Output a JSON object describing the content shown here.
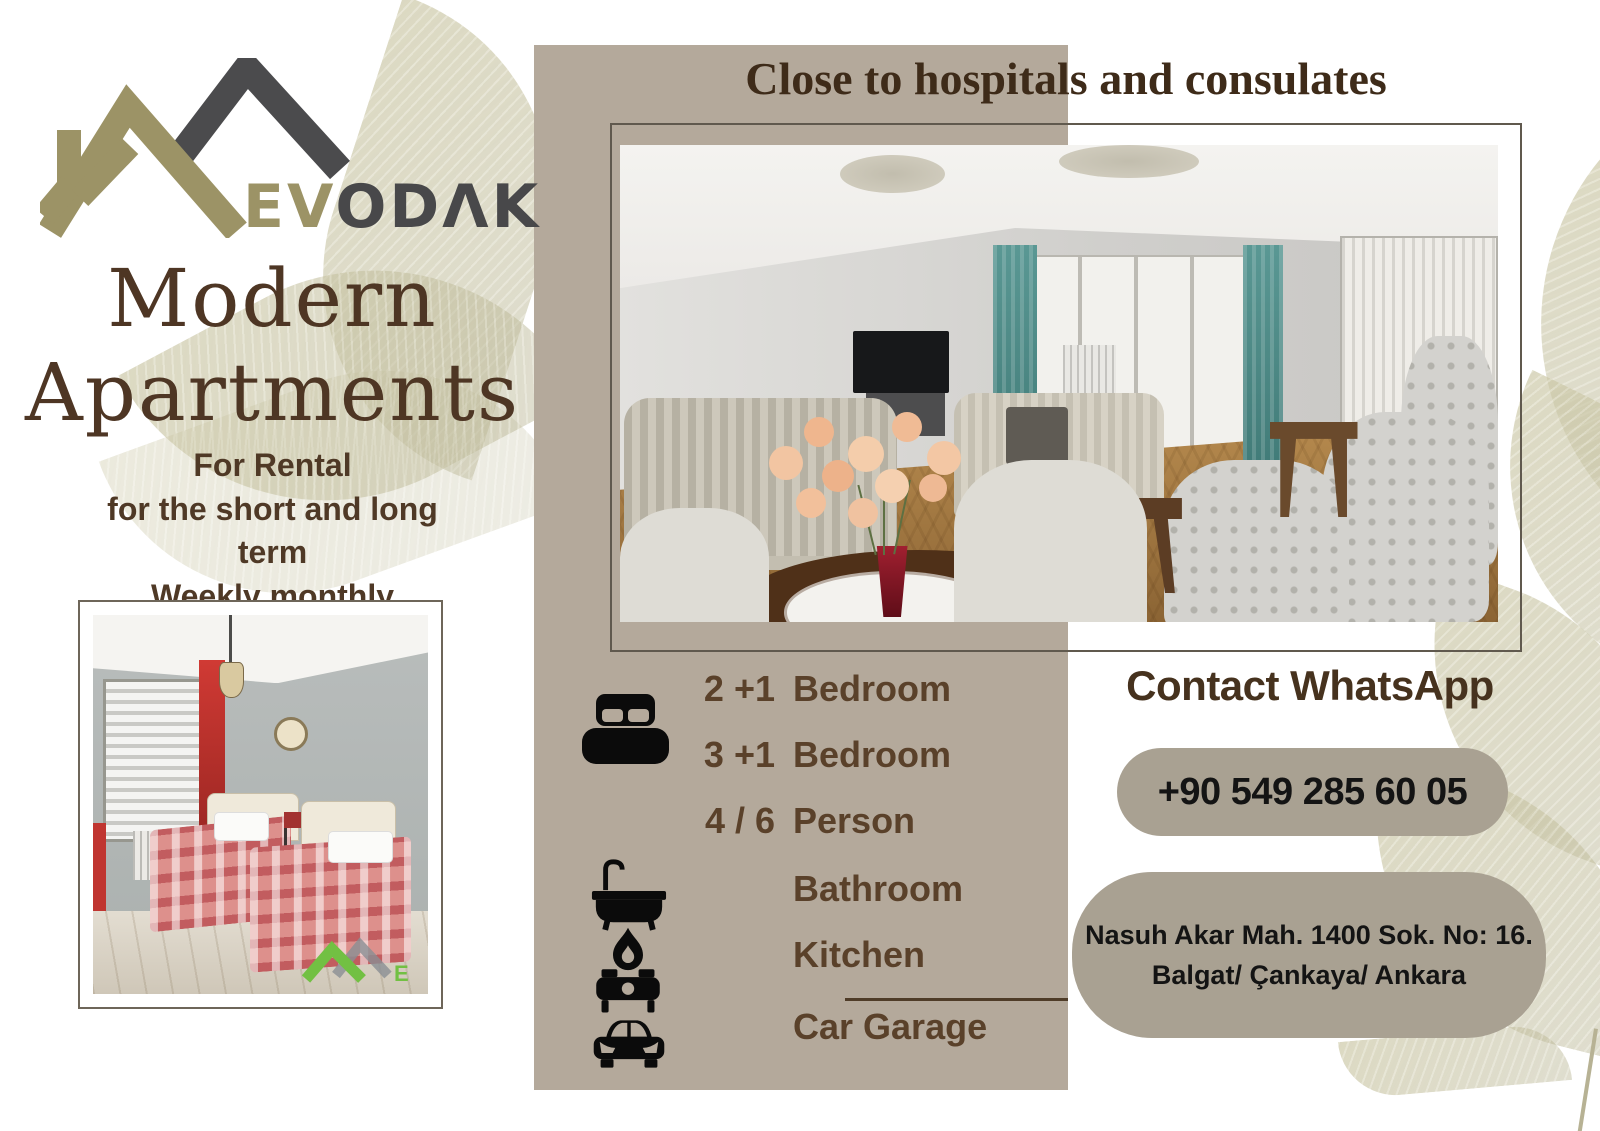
{
  "brand": {
    "name_primary": "EV",
    "name_secondary": "ODΛK"
  },
  "left_panel": {
    "title_line1": "Modern",
    "title_line2": "Apartments",
    "tagline_line1": "For Rental",
    "tagline_line2": "for the short and long",
    "tagline_line3": "term",
    "tagline_line4": "Weekly monthly",
    "photo_watermark_letter": "E"
  },
  "headline": "Close to hospitals and consulates",
  "features": {
    "rows": [
      {
        "qty": "2 +1",
        "label": "Bedroom"
      },
      {
        "qty": "3 +1",
        "label": "Bedroom"
      },
      {
        "qty": "4 / 6",
        "label": "Person"
      },
      {
        "qty": "",
        "label": "Bathroom"
      },
      {
        "qty": "",
        "label": "Kitchen"
      },
      {
        "qty": "",
        "label": "Car Garage"
      }
    ],
    "icons": [
      "bed-icon",
      "bathtub-icon",
      "stove-icon",
      "car-icon"
    ]
  },
  "contact": {
    "heading": "Contact WhatsApp",
    "phone": "+90 549 285 60 05",
    "address_line1": "Nasuh Akar Mah. 1400 Sok. No: 16.",
    "address_line2": "Balgat/ Çankaya/ Ankara"
  },
  "colors": {
    "band": "#b4a99b",
    "pill": "#a9a192",
    "text_brown": "#4e3624",
    "feature_brown": "#5a412a",
    "logo_olive": "#9c9366",
    "logo_gray": "#48484a",
    "leaf": "#c5c1a0",
    "watermark_green": "#72c043"
  }
}
